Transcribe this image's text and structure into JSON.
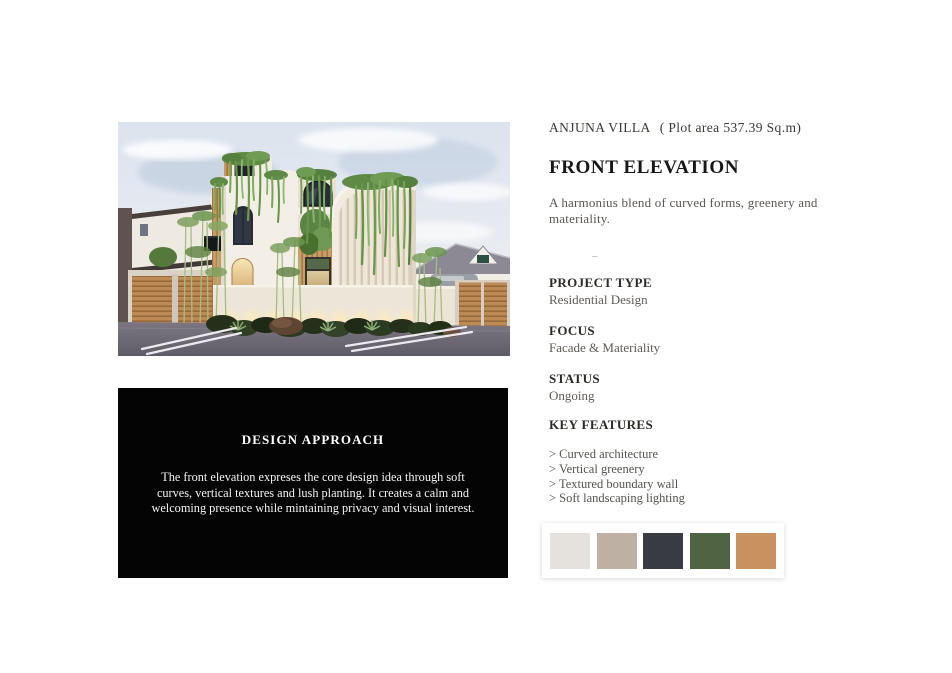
{
  "design_approach": {
    "title": "DESIGN APPROACH",
    "body": "The front elevation expreses the core design idea through soft curves, vertical textures and lush planting. It creates a calm and welcoming presence while mintaining privacy and visual interest."
  },
  "info": {
    "project_title": "ANJUNA VILLA",
    "plot_area": "( Plot area 537.39 Sq.m)",
    "heading": "FRONT ELEVATION",
    "subtitle": "A harmonius blend of curved forms, greenery and materiality.",
    "divider": "–",
    "sections": [
      {
        "label": "PROJECT TYPE",
        "value": "Residential Design"
      },
      {
        "label": "FOCUS",
        "value": "Facade & Materiality"
      },
      {
        "label": "STATUS",
        "value": "Ongoing"
      }
    ],
    "key_features_label": "KEY FEATURES",
    "key_features": [
      "> Curved architecture",
      "> Vertical greenery",
      "> Textured boundary wall",
      "> Soft landscaping lighting"
    ],
    "color_palette_label": "COLOR PALETTE",
    "palette": [
      {
        "name": "off-white",
        "hex": "#e5e1dc"
      },
      {
        "name": "warm-taupe",
        "hex": "#beb0a3"
      },
      {
        "name": "charcoal",
        "hex": "#383c42"
      },
      {
        "name": "olive-green",
        "hex": "#506442"
      },
      {
        "name": "terracotta",
        "hex": "#c8915f"
      }
    ]
  },
  "hero": {
    "description": "Photorealistic front elevation render of Anjuna Villa",
    "colors": {
      "sky": "#dfe7f1",
      "facade_white": "#f3eee5",
      "wood_slats": "#c2955f",
      "greenery": "#76a055",
      "road": "#6e6a76",
      "boundary_wall": "#ece6da"
    }
  }
}
